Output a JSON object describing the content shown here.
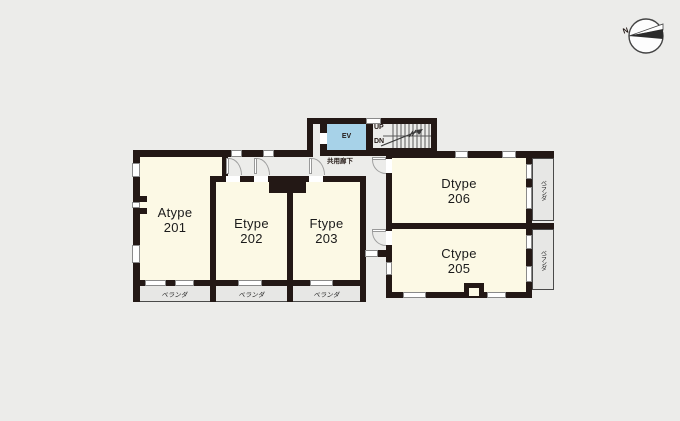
{
  "compass": {
    "north_label": "N"
  },
  "corridor": {
    "label": "共用廊下"
  },
  "elevator": {
    "label": "EV"
  },
  "stairs": {
    "up_label": "UP",
    "down_label": "DN"
  },
  "rooms": [
    {
      "type": "Atype",
      "number": "201"
    },
    {
      "type": "Etype",
      "number": "202"
    },
    {
      "type": "Ftype",
      "number": "203"
    },
    {
      "type": "Ctype",
      "number": "205"
    },
    {
      "type": "Dtype",
      "number": "206"
    }
  ],
  "balconies": {
    "bottom": [
      "ベランダ",
      "ベランダ",
      "ベランダ"
    ],
    "right": [
      "ベランダ",
      "ベランダ"
    ]
  },
  "colors": {
    "background": "#ECECEA",
    "wall": "#231815",
    "room_fill": "#FCF9E5",
    "balcony_fill": "#E7E7E5",
    "elevator_fill": "#A7D2E8"
  }
}
